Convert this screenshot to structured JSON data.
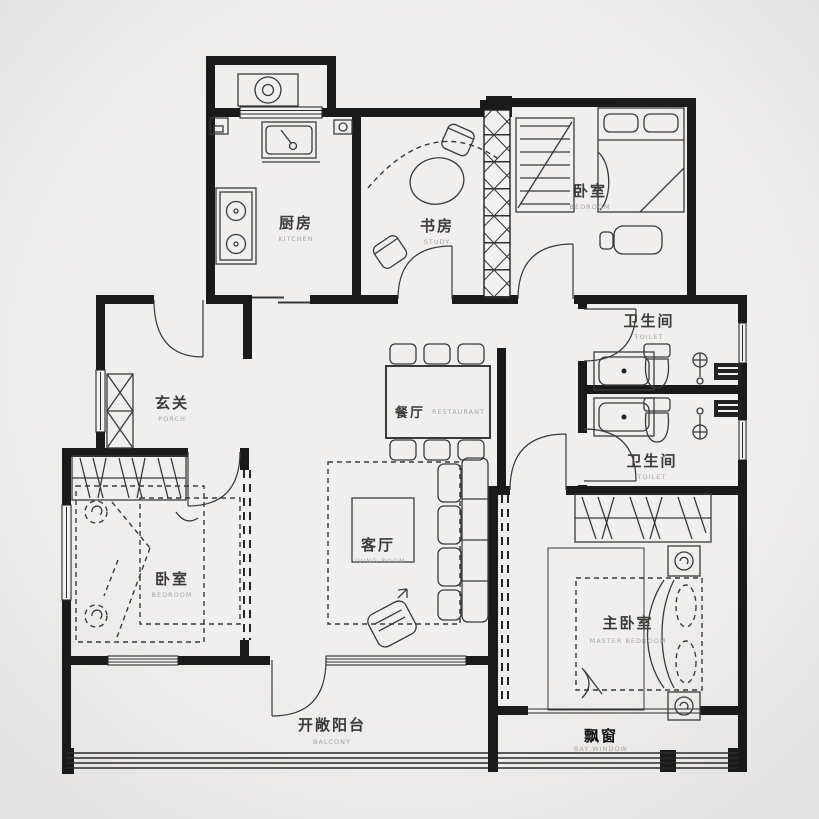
{
  "meta": {
    "type": "residential floor plan",
    "style": "black-and-white architectural drawing"
  },
  "colors": {
    "background": "#ecebe9",
    "wall": "#1a1a1a",
    "furniture_line": "#3a3a3a",
    "label": "#3d3b38",
    "sublabel": "#a9a7a3"
  },
  "rooms": [
    {
      "id": "kitchen",
      "name": "厨房",
      "en": "KITCHEN"
    },
    {
      "id": "study",
      "name": "书房",
      "en": "STUDY"
    },
    {
      "id": "bedroom-north",
      "name": "卧室",
      "en": "BEDROOM"
    },
    {
      "id": "toilet-north",
      "name": "卫生间",
      "en": "TOILET"
    },
    {
      "id": "toilet-south",
      "name": "卫生间",
      "en": "TOILET"
    },
    {
      "id": "porch",
      "name": "玄关",
      "en": "PORCH"
    },
    {
      "id": "dining",
      "name": "餐厅",
      "en": "RESTAURANT"
    },
    {
      "id": "living",
      "name": "客厅",
      "en": "LIVING ROOM"
    },
    {
      "id": "bedroom-west",
      "name": "卧室",
      "en": "BEDROOM"
    },
    {
      "id": "master-bedroom",
      "name": "主卧室",
      "en": "MASTER BEDROOM"
    },
    {
      "id": "balcony",
      "name": "开敞阳台",
      "en": "BALCONY"
    },
    {
      "id": "bay-window",
      "name": "飘窗",
      "en": "BAY WINDOW"
    }
  ],
  "fixtures": [
    "washing-machine",
    "kitchen-sink",
    "gas-stove",
    "wall-cabinet",
    "sliding-door",
    "round-table",
    "desk-chair",
    "curtain-arc",
    "flue-shaft",
    "wardrobe",
    "single-bed",
    "study-desk",
    "bathroom-sink",
    "toilet-bowl",
    "shower-head",
    "shower-panel",
    "dining-table",
    "dining-chair",
    "sofa",
    "coffee-table",
    "lounge-chair",
    "area-rug",
    "double-bed",
    "pillow",
    "nightstand-lamp",
    "shoe-cabinet",
    "entry-door",
    "window",
    "bay-window-seat",
    "balcony-railing"
  ]
}
